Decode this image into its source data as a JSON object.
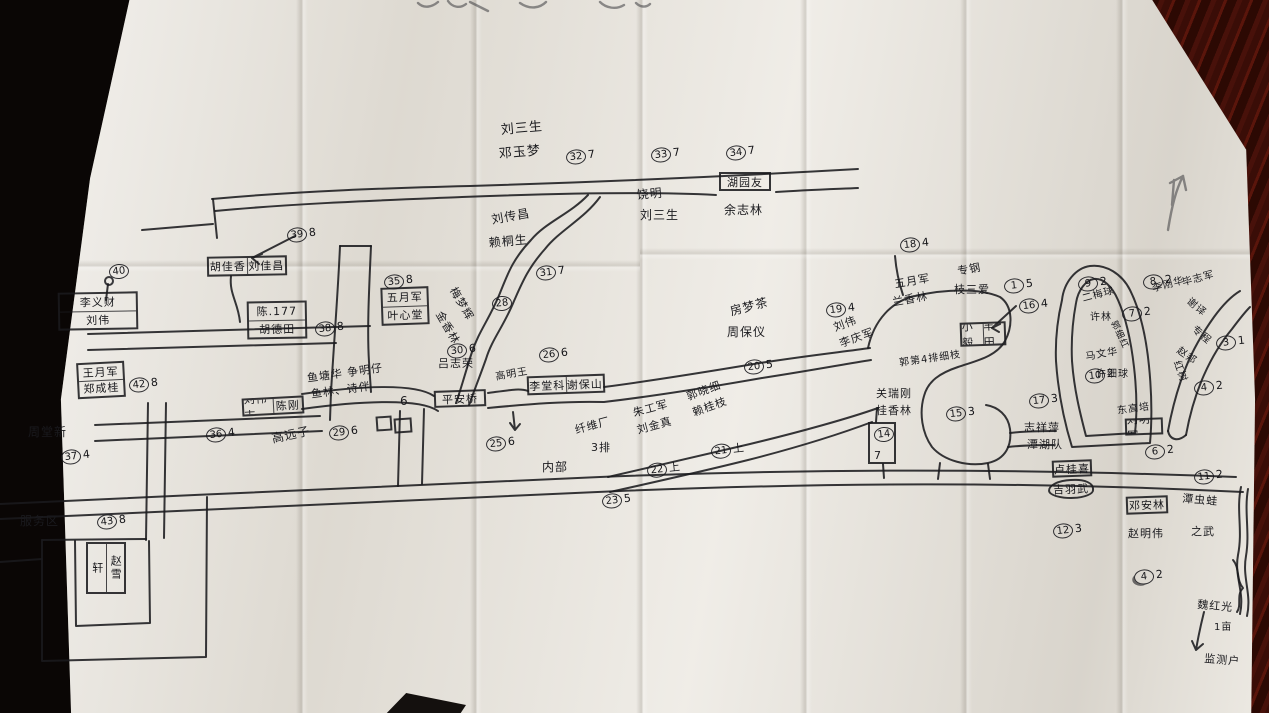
{
  "photo": {
    "table_color": "#3a0d07",
    "paper_color": "#e9e5dd",
    "ink_color": "#1a1a1e"
  },
  "map": {
    "markers": [
      {
        "n": "32",
        "suf": "7",
        "x": 566,
        "y": 149
      },
      {
        "n": "33",
        "suf": "7",
        "x": 651,
        "y": 147
      },
      {
        "n": "34",
        "suf": "7",
        "x": 726,
        "y": 145
      },
      {
        "n": "31",
        "suf": "7",
        "x": 536,
        "y": 265
      },
      {
        "n": "28",
        "suf": "",
        "x": 492,
        "y": 296
      },
      {
        "n": "30",
        "suf": "6",
        "x": 447,
        "y": 343
      },
      {
        "n": "26",
        "suf": "6",
        "x": 539,
        "y": 347
      },
      {
        "n": "39",
        "suf": "8",
        "x": 287,
        "y": 227
      },
      {
        "n": "35",
        "suf": "8",
        "x": 384,
        "y": 274
      },
      {
        "n": "38",
        "suf": "8",
        "x": 315,
        "y": 321
      },
      {
        "n": "40",
        "suf": "",
        "x": 109,
        "y": 264
      },
      {
        "n": "42",
        "suf": "8",
        "x": 129,
        "y": 377
      },
      {
        "n": "36",
        "suf": "4",
        "x": 206,
        "y": 427
      },
      {
        "n": "29",
        "suf": "6",
        "x": 329,
        "y": 425
      },
      {
        "n": "37",
        "suf": "4",
        "x": 61,
        "y": 449
      },
      {
        "n": "43",
        "suf": "8",
        "x": 97,
        "y": 514
      },
      {
        "n": "25",
        "suf": "6",
        "x": 486,
        "y": 436
      },
      {
        "n": "23",
        "suf": "5",
        "x": 602,
        "y": 493
      },
      {
        "n": "22",
        "suf": "上",
        "x": 647,
        "y": 462
      },
      {
        "n": "21",
        "suf": "上",
        "x": 711,
        "y": 443
      },
      {
        "n": "20",
        "suf": "5",
        "x": 744,
        "y": 359
      },
      {
        "n": "19",
        "suf": "4",
        "x": 826,
        "y": 302
      },
      {
        "n": "18",
        "suf": "4",
        "x": 900,
        "y": 237
      },
      {
        "n": "1",
        "suf": "5",
        "x": 1004,
        "y": 278
      },
      {
        "n": "16",
        "suf": "4",
        "x": 1019,
        "y": 298
      },
      {
        "n": "14",
        "suf": "",
        "x": 874,
        "y": 427
      },
      {
        "n": "15",
        "suf": "3",
        "x": 946,
        "y": 406
      },
      {
        "n": "17",
        "suf": "3",
        "x": 1029,
        "y": 393
      },
      {
        "n": "9",
        "suf": "2",
        "x": 1078,
        "y": 276
      },
      {
        "n": "7",
        "suf": "2",
        "x": 1122,
        "y": 306
      },
      {
        "n": "10",
        "suf": "2",
        "x": 1085,
        "y": 368
      },
      {
        "n": "8",
        "suf": "2",
        "x": 1143,
        "y": 274
      },
      {
        "n": "3",
        "suf": "1",
        "x": 1216,
        "y": 335
      },
      {
        "n": "4",
        "suf": "2",
        "x": 1194,
        "y": 380
      },
      {
        "n": "4",
        "suf": "2",
        "x": 1134,
        "y": 569,
        "d": true
      },
      {
        "n": "6",
        "suf": "2",
        "x": 1145,
        "y": 444
      },
      {
        "n": "11",
        "suf": "2",
        "x": 1194,
        "y": 469
      },
      {
        "n": "12",
        "suf": "3",
        "x": 1053,
        "y": 523
      }
    ],
    "labels": [
      {
        "t": "刘三生",
        "x": 500,
        "y": 119,
        "r": -5,
        "fs": 13
      },
      {
        "t": "邓玉梦",
        "x": 498,
        "y": 143,
        "r": -5,
        "fs": 13
      },
      {
        "t": "饶明",
        "x": 636,
        "y": 186,
        "r": -5,
        "fs": 12
      },
      {
        "t": "刘三生",
        "x": 640,
        "y": 206,
        "r": 0,
        "fs": 12
      },
      {
        "t": "余志林",
        "x": 724,
        "y": 201,
        "r": 0,
        "fs": 12
      },
      {
        "t": "刘传昌",
        "x": 490,
        "y": 211,
        "r": -10,
        "fs": 12
      },
      {
        "t": "赖桐生",
        "x": 488,
        "y": 234,
        "r": -5,
        "fs": 12
      },
      {
        "t": "梅梦辉",
        "x": 460,
        "y": 284,
        "r": 60,
        "fs": 11
      },
      {
        "t": "金香林",
        "x": 446,
        "y": 308,
        "r": 60,
        "fs": 11
      },
      {
        "t": "吕志荣",
        "x": 438,
        "y": 355,
        "r": 0,
        "fs": 11
      },
      {
        "t": "高明王",
        "x": 494,
        "y": 368,
        "r": -10,
        "fs": 10
      },
      {
        "t": "鱼塘华 争明仔",
        "x": 306,
        "y": 370,
        "r": -8,
        "fs": 11
      },
      {
        "t": "鱼林、诗伴",
        "x": 310,
        "y": 386,
        "r": -8,
        "fs": 11
      },
      {
        "t": "6",
        "x": 400,
        "y": 394,
        "r": 0,
        "fs": 12
      },
      {
        "t": "高远子",
        "x": 270,
        "y": 430,
        "r": -12,
        "fs": 12
      },
      {
        "t": "周堂新",
        "x": 28,
        "y": 423,
        "r": 0,
        "fs": 12
      },
      {
        "t": "服务区",
        "x": 20,
        "y": 512,
        "r": 0,
        "fs": 12
      },
      {
        "t": "内部",
        "x": 542,
        "y": 458,
        "r": 0,
        "fs": 12
      },
      {
        "t": "纤维厂",
        "x": 573,
        "y": 422,
        "r": -15,
        "fs": 11
      },
      {
        "t": "3排",
        "x": 591,
        "y": 439,
        "r": 0,
        "fs": 11
      },
      {
        "t": "朱工军",
        "x": 631,
        "y": 405,
        "r": -15,
        "fs": 11
      },
      {
        "t": "刘金真",
        "x": 635,
        "y": 422,
        "r": -15,
        "fs": 11
      },
      {
        "t": "郭晓细",
        "x": 684,
        "y": 389,
        "r": -20,
        "fs": 11
      },
      {
        "t": "赖桂枝",
        "x": 690,
        "y": 405,
        "r": -20,
        "fs": 11
      },
      {
        "t": "房梦茶",
        "x": 728,
        "y": 303,
        "r": -15,
        "fs": 12
      },
      {
        "t": "周保仪",
        "x": 727,
        "y": 323,
        "r": 0,
        "fs": 12
      },
      {
        "t": "刘伟",
        "x": 831,
        "y": 320,
        "r": -20,
        "fs": 11
      },
      {
        "t": "李庆军",
        "x": 837,
        "y": 336,
        "r": -20,
        "fs": 11
      },
      {
        "t": "五月军",
        "x": 893,
        "y": 276,
        "r": -10,
        "fs": 11
      },
      {
        "t": "兰香林",
        "x": 891,
        "y": 294,
        "r": -10,
        "fs": 11
      },
      {
        "t": "专钢",
        "x": 956,
        "y": 263,
        "r": -10,
        "fs": 11
      },
      {
        "t": "枝三爱",
        "x": 954,
        "y": 281,
        "r": 0,
        "fs": 11
      },
      {
        "t": "郭第4排细枝",
        "x": 898,
        "y": 354,
        "r": -8,
        "fs": 10
      },
      {
        "t": "关瑞刚",
        "x": 876,
        "y": 385,
        "r": 0,
        "fs": 11
      },
      {
        "t": "桂香林",
        "x": 876,
        "y": 402,
        "r": 0,
        "fs": 11
      },
      {
        "t": "7",
        "x": 874,
        "y": 449,
        "r": 0,
        "fs": 11
      },
      {
        "t": "志祥萍",
        "x": 1024,
        "y": 419,
        "r": 0,
        "fs": 11
      },
      {
        "t": "潭湖队",
        "x": 1027,
        "y": 436,
        "r": 0,
        "fs": 11
      },
      {
        "t": "二梅球",
        "x": 1080,
        "y": 290,
        "r": -15,
        "fs": 10
      },
      {
        "t": "许林",
        "x": 1090,
        "y": 308,
        "r": 0,
        "fs": 10
      },
      {
        "t": "郭细红",
        "x": 1120,
        "y": 318,
        "r": 65,
        "fs": 9
      },
      {
        "t": "马文华",
        "x": 1084,
        "y": 348,
        "r": -10,
        "fs": 10
      },
      {
        "t": "许细球",
        "x": 1096,
        "y": 365,
        "r": 0,
        "fs": 10
      },
      {
        "t": "东高培",
        "x": 1116,
        "y": 402,
        "r": -8,
        "fs": 10
      },
      {
        "t": "李刚华",
        "x": 1150,
        "y": 280,
        "r": -15,
        "fs": 10
      },
      {
        "t": "毕志军",
        "x": 1180,
        "y": 274,
        "r": -15,
        "fs": 10
      },
      {
        "t": "谢译",
        "x": 1194,
        "y": 293,
        "r": 40,
        "fs": 10
      },
      {
        "t": "专程",
        "x": 1199,
        "y": 321,
        "r": 40,
        "fs": 10
      },
      {
        "t": "赵邦",
        "x": 1183,
        "y": 342,
        "r": 35,
        "fs": 10
      },
      {
        "t": "红树",
        "x": 1185,
        "y": 358,
        "r": 70,
        "fs": 10
      },
      {
        "t": "赵明伟",
        "x": 1128,
        "y": 525,
        "r": 0,
        "fs": 11
      },
      {
        "t": "潭虫蛙",
        "x": 1183,
        "y": 490,
        "r": 5,
        "fs": 11
      },
      {
        "t": "之武",
        "x": 1191,
        "y": 523,
        "r": 0,
        "fs": 11
      },
      {
        "t": "魏红光",
        "x": 1198,
        "y": 596,
        "r": 5,
        "fs": 11
      },
      {
        "t": "1亩",
        "x": 1214,
        "y": 618,
        "r": 0,
        "fs": 10
      },
      {
        "t": "监测户",
        "x": 1205,
        "y": 650,
        "r": 5,
        "fs": 11
      }
    ],
    "buildings": [
      {
        "cells": [
          "胡佳香",
          "刘佳昌"
        ],
        "dir": "cols",
        "x": 207,
        "y": 256,
        "w": 80,
        "h": 20,
        "r": -1
      },
      {
        "cells": [
          "李义财",
          "刘伟"
        ],
        "dir": "rows",
        "x": 58,
        "y": 292,
        "w": 80,
        "h": 38,
        "r": -1
      },
      {
        "cells": [
          "陈.177",
          "胡德田"
        ],
        "dir": "rows",
        "x": 247,
        "y": 301,
        "w": 60,
        "h": 38,
        "r": -1
      },
      {
        "cells": [
          "五月军",
          "叶心堂"
        ],
        "dir": "rows",
        "x": 381,
        "y": 287,
        "w": 48,
        "h": 38,
        "r": -2
      },
      {
        "cells": [
          "王月军",
          "郑成桂"
        ],
        "dir": "rows",
        "x": 77,
        "y": 362,
        "w": 48,
        "h": 36,
        "r": -3
      },
      {
        "cells": [
          "刘伟志",
          "陈刚"
        ],
        "dir": "cols",
        "x": 242,
        "y": 397,
        "w": 62,
        "h": 18,
        "r": -3
      },
      {
        "cells": [
          "李堂科",
          "谢保山"
        ],
        "dir": "cols",
        "x": 527,
        "y": 375,
        "w": 78,
        "h": 19,
        "r": -2
      },
      {
        "cells": [
          "平安桥"
        ],
        "dir": "rows",
        "x": 434,
        "y": 390,
        "w": 52,
        "h": 17,
        "r": -2
      },
      {
        "cells": [
          "湖园友"
        ],
        "dir": "rows",
        "x": 719,
        "y": 172,
        "w": 52,
        "h": 19,
        "r": 0
      },
      {
        "cells": [
          "小毅",
          "丰田"
        ],
        "dir": "cols",
        "x": 960,
        "y": 322,
        "w": 46,
        "h": 24,
        "r": -2
      },
      {
        "cells": [
          "刘明军"
        ],
        "dir": "rows",
        "x": 1125,
        "y": 418,
        "w": 38,
        "h": 17,
        "r": -2
      },
      {
        "cells": [
          "卢桂喜"
        ],
        "dir": "rows",
        "x": 1052,
        "y": 460,
        "w": 40,
        "h": 17,
        "r": -2
      },
      {
        "cells": [
          "吉羽武"
        ],
        "dir": "rows",
        "x": 1048,
        "y": 479,
        "w": 46,
        "h": 20,
        "r": -2,
        "blob": true
      },
      {
        "cells": [
          "邓安林"
        ],
        "dir": "rows",
        "x": 1126,
        "y": 496,
        "w": 42,
        "h": 18,
        "r": -2
      },
      {
        "cells": [
          "轩",
          "赵雪"
        ],
        "dir": "cols",
        "x": 86,
        "y": 542,
        "w": 40,
        "h": 52,
        "r": 0,
        "vert": true
      },
      {
        "cells": [
          ""
        ],
        "dir": "rows",
        "x": 868,
        "y": 422,
        "w": 28,
        "h": 42,
        "r": 0
      },
      {
        "cells": [
          ""
        ],
        "dir": "rows",
        "x": 376,
        "y": 416,
        "w": 16,
        "h": 15,
        "r": -4
      },
      {
        "cells": [
          ""
        ],
        "dir": "rows",
        "x": 394,
        "y": 418,
        "w": 18,
        "h": 15,
        "r": -4
      }
    ]
  }
}
